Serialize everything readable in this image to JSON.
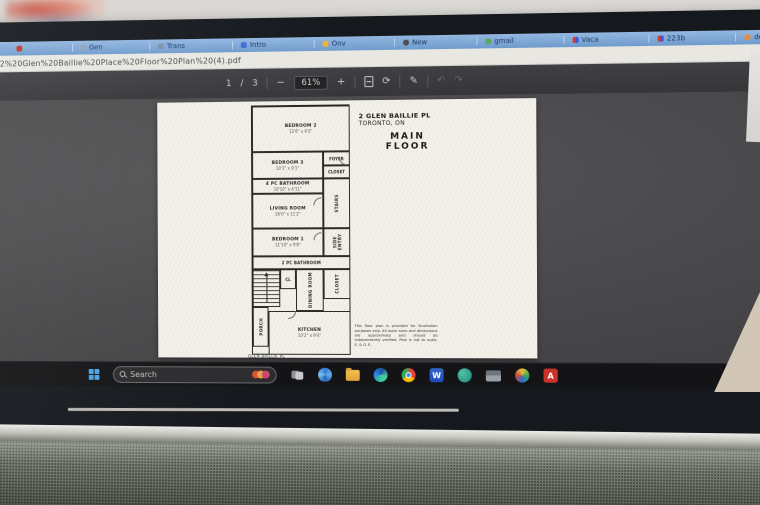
{
  "colors": {
    "bookmarks_bar_blue": "#7fa7d6",
    "toolbar_bg": "#3a3a3e",
    "viewer_bg": "#4a4a4c",
    "page_bg": "#f4f1ea",
    "taskbar_bg": "#141416",
    "start_blue": "#4aa3e8",
    "acrobat_red": "#c9332a"
  },
  "browser": {
    "bookmarks": [
      {
        "label": ""
      },
      {
        "label": "Gen"
      },
      {
        "label": "Trans"
      },
      {
        "label": "Intro"
      },
      {
        "label": "Onv"
      },
      {
        "label": "New"
      },
      {
        "label": "gmail"
      },
      {
        "label": "Vaca"
      },
      {
        "label": "223b"
      },
      {
        "label": "doing"
      }
    ],
    "address_bar": {
      "url": "le/2%20Glen%20Baillie%20Place%20Floor%20Plan%20(4).pdf"
    },
    "pdf_toolbar": {
      "page_current": "1",
      "page_sep": "/",
      "page_total": "3",
      "zoom_out": "−",
      "zoom_level": "61%",
      "zoom_in": "+",
      "rotate_glyph": "⟳",
      "draw_glyph": "✎",
      "undo_glyph": "↶",
      "redo_glyph": "↷"
    }
  },
  "pdf_doc": {
    "address_line1": "2 GLEN BAILLIE PL",
    "address_line2": "TORONTO, ON",
    "floor_word1": "MAIN",
    "floor_word2": "FLOOR",
    "rooms": [
      {
        "name": "BEDROOM 2",
        "dims": "12'6\" x 9'2\""
      },
      {
        "name": "BEDROOM 3",
        "dims": "10'1\" x 9'1\""
      },
      {
        "name": "4 PC BATHROOM",
        "dims": "10'10\" x 4'11\""
      },
      {
        "name": "LIVING ROOM",
        "dims": "16'0\" x 11'2\""
      },
      {
        "name": "BEDROOM 1",
        "dims": "11'10\" x 9'8\""
      },
      {
        "name": "2 PC BATHROOM",
        "dims": "10'9\" x 4'1\""
      },
      {
        "name": "KITCHEN",
        "dims": "10'2\" x 9'4\""
      }
    ],
    "small_labels": {
      "foyer": "FOYER",
      "closet_a": "CLOSET",
      "stairs_hall": "STAIRS",
      "side_entry": "SIDE ENTRY",
      "cl": "CL",
      "dining": "DINING ROOM",
      "closet_b": "CLOSET",
      "porch": "PORCH"
    },
    "footer": "GLEN BAILLIE PL",
    "disclaimer": "This floor plan is provided for illustration purposes only. All room sizes and dimensions are approximate and should be independently verified. Plan is not to scale. E. & O. E."
  },
  "taskbar": {
    "search_label": "Search"
  }
}
